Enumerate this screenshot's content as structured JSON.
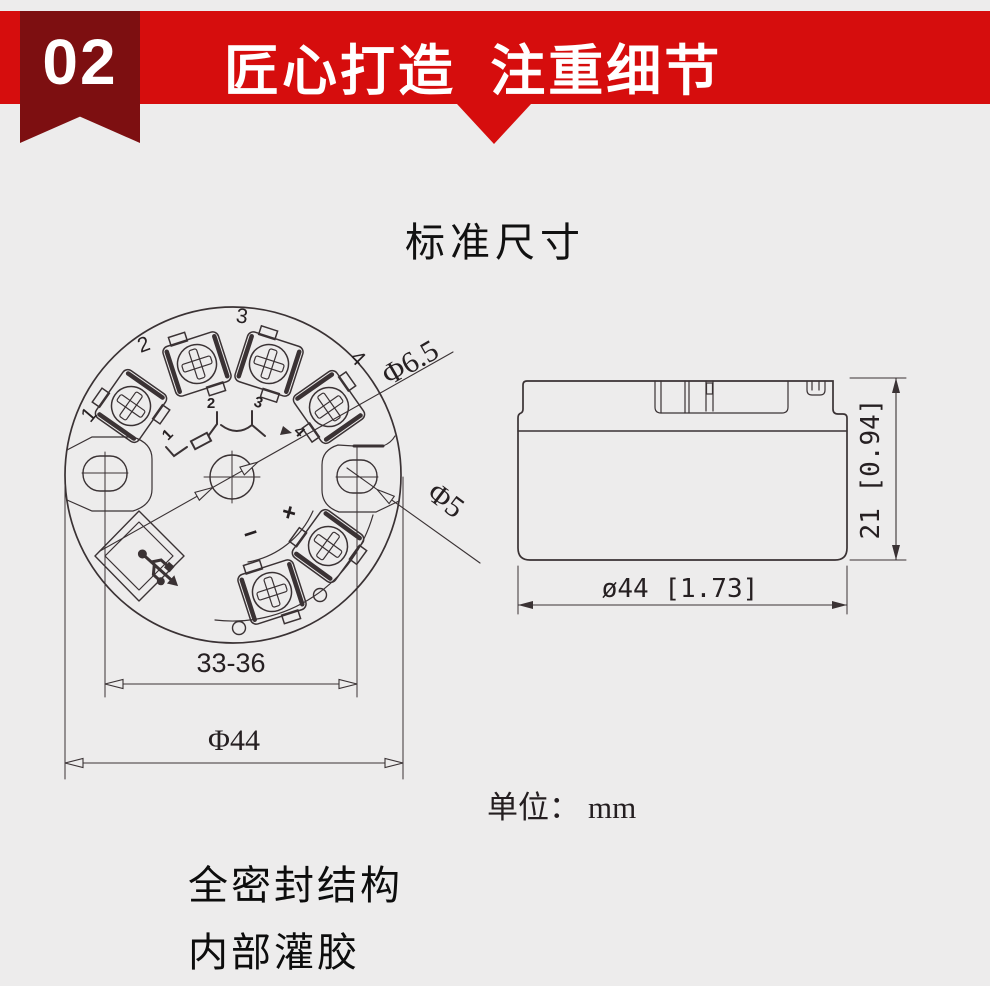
{
  "colors": {
    "background": "#edecec",
    "banner": "#d60d0d",
    "ribbon": "#7d0f11",
    "line": "#3a3234",
    "text": "#1a1a1a"
  },
  "header": {
    "badge_number": "02",
    "title": "匠心打造 注重细节"
  },
  "section": {
    "title": "标准尺寸"
  },
  "top_view": {
    "terminal_numbers": [
      "1",
      "2",
      "3",
      "4"
    ],
    "schematic_numbers": [
      "1",
      "2",
      "3",
      "4"
    ],
    "polarity": {
      "plus": "+",
      "minus": "−"
    },
    "dimensions": {
      "center_hole": "Φ6.5",
      "mounting_hole": "Φ5",
      "hole_spacing": "33-36",
      "outer_diameter": "Φ44"
    }
  },
  "side_view": {
    "dimensions": {
      "height": "21 [0.94]",
      "diameter": "ø44 [1.73]"
    }
  },
  "unit_note": {
    "label": "单位：",
    "value": "mm"
  },
  "features": [
    "全密封结构",
    "内部灌胶"
  ]
}
